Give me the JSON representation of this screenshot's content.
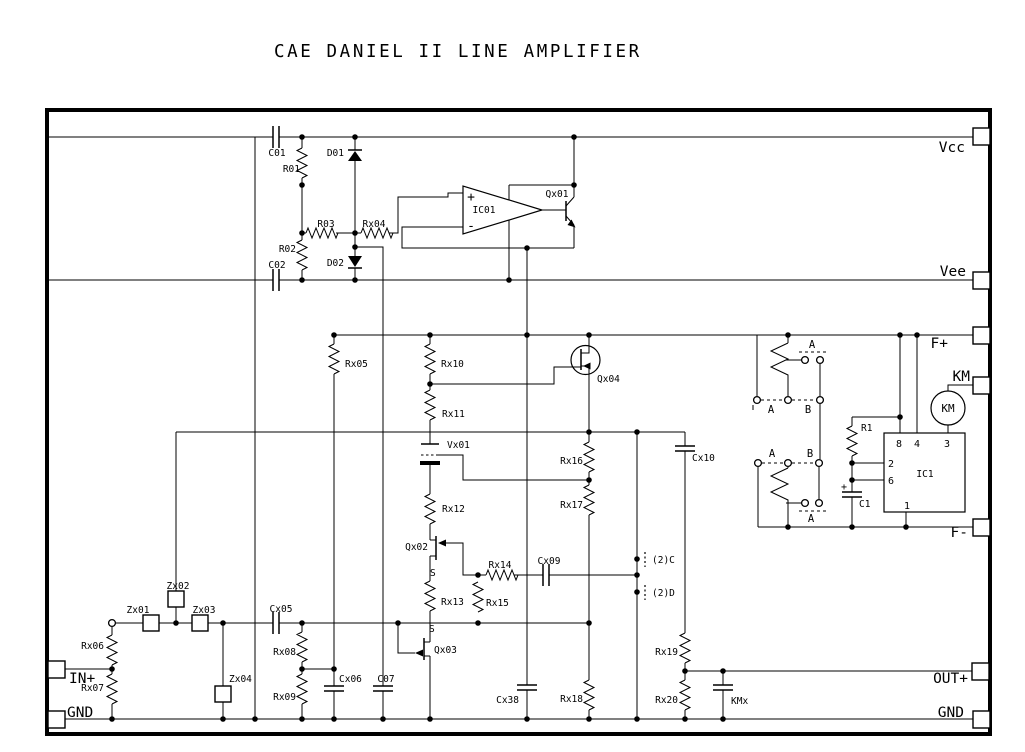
{
  "title": "CAE DANIEL II LINE AMPLIFIER",
  "colors": {
    "ink": "#000000",
    "paper": "#ffffff"
  },
  "terminals": {
    "vcc": "Vcc",
    "vee": "Vee",
    "f_plus": "F+",
    "km": "KM",
    "f_minus": "F-",
    "out_plus": "OUT+",
    "gnd_right": "GND",
    "in_plus": "IN+",
    "gnd_left": "GND"
  },
  "components": {
    "c01": "C01",
    "r01": "R01",
    "r02": "R02",
    "c02": "C02",
    "d01": "D01",
    "d02": "D02",
    "r03": "R03",
    "rx04": "Rx04",
    "ic01": "IC01",
    "qx01": "Qx01",
    "rx05": "Rx05",
    "rx10": "Rx10",
    "rx11": "Rx11",
    "qx04": "Qx04",
    "vx01": "Vx01",
    "rx12": "Rx12",
    "qx02": "Qx02",
    "rx13": "Rx13",
    "qx03": "Qx03",
    "rx14": "Rx14",
    "rx15": "Rx15",
    "cx09": "Cx09",
    "rx16": "Rx16",
    "rx17": "Rx17",
    "cx10": "Cx10",
    "cx38": "Cx38",
    "rx18": "Rx18",
    "zx01": "Zx01",
    "zx02": "Zx02",
    "zx03": "Zx03",
    "zx04": "Zx04",
    "rx06": "Rx06",
    "rx07": "Rx07",
    "cx05": "Cx05",
    "rx08": "Rx08",
    "rx09": "Rx09",
    "cx06": "Cx06",
    "c07": "C07",
    "rx19": "Rx19",
    "rx20": "Rx20",
    "kmx": "KMx",
    "r1": "R1",
    "c1": "C1",
    "ic1": "IC1",
    "km_coil": "KM"
  },
  "opamp": {
    "plus": "+",
    "minus": "-"
  },
  "ic1_pins": {
    "p8": "8",
    "p4": "4",
    "p3": "3",
    "p2": "2",
    "p6": "6",
    "p1": "1"
  },
  "connectors": {
    "ch2_c": "(2)C",
    "ch2_d": "(2)D"
  },
  "annotations": {
    "s_qx02": "S",
    "s_qx03": "S",
    "c1_plus": "+"
  },
  "relay_contacts": {
    "upper_top": "A",
    "upper_bottom_left": "A",
    "upper_bottom_right": "B",
    "lower_top_left": "A",
    "lower_top_right": "B",
    "lower_bottom": "A"
  }
}
